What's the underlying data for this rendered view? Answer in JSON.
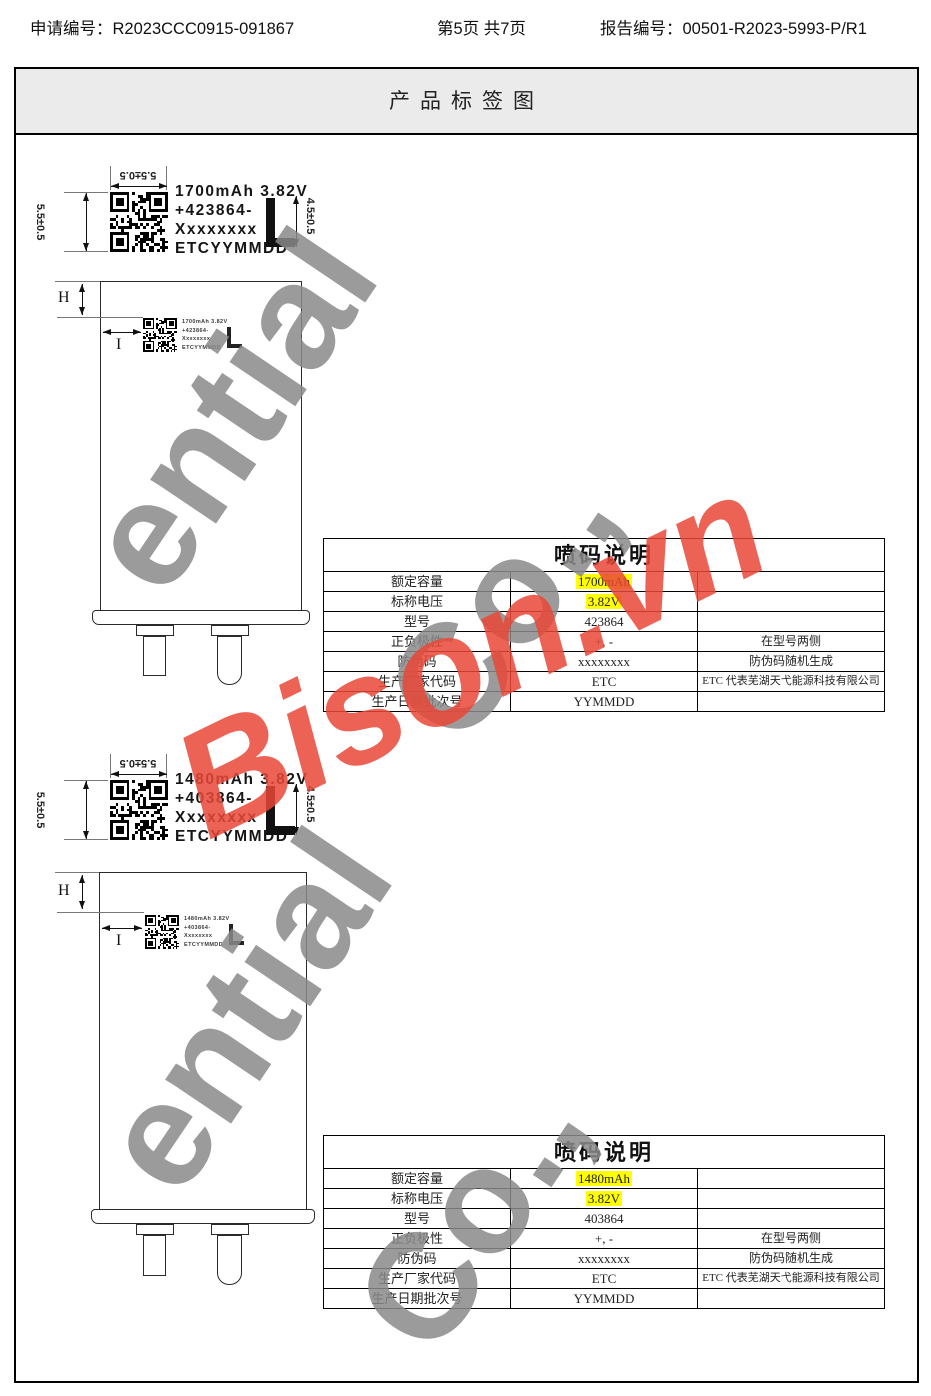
{
  "header": {
    "application_label": "申请编号：R2023CCC0915-091867",
    "page_label": "第5页  共7页",
    "report_label": "报告编号：00501-R2023-5993-P/R1"
  },
  "title": "产品标签图",
  "watermarks": {
    "gray_word": "ential",
    "gray_suffix": "Co.,",
    "red_text": "Bison.vn",
    "gray_color": "#8a8a8a",
    "red_color": "#e94837",
    "highlight_color": "#ffff00"
  },
  "sections": [
    {
      "label": {
        "line1": "1700mAh 3.82V",
        "line2": "+423864-",
        "line3": "Xxxxxxxx",
        "line4": "ETCYYMMDD"
      },
      "dims": {
        "top": "5.5±0.5",
        "left": "5.5±0.5",
        "right": "4.5±0.5",
        "h": "H",
        "i": "I"
      },
      "table": {
        "title": "喷码说明",
        "rows": [
          {
            "name": "额定容量",
            "value": "1700mAh",
            "note": ""
          },
          {
            "name": "标称电压",
            "value": "3.82V",
            "note": ""
          },
          {
            "name": "型号",
            "value": "423864",
            "note": ""
          },
          {
            "name": "正负极性",
            "value": "+, -",
            "note": "在型号两侧"
          },
          {
            "name": "防伪码",
            "value": "xxxxxxxx",
            "note": "防伪码随机生成"
          },
          {
            "name": "生产厂家代码",
            "value": "ETC",
            "note": "ETC 代表芜湖天弋能源科技有限公司"
          },
          {
            "name": "生产日期批次号",
            "value": "YYMMDD",
            "note": ""
          }
        ]
      }
    },
    {
      "label": {
        "line1": "1480mAh 3.82V",
        "line2": "+403864-",
        "line3": "Xxxxxxxx",
        "line4": "ETCYYMMDD"
      },
      "dims": {
        "top": "5.5±0.5",
        "left": "5.5±0.5",
        "right": "4.5±0.5",
        "h": "H",
        "i": "I"
      },
      "table": {
        "title": "喷码说明",
        "rows": [
          {
            "name": "额定容量",
            "value": "1480mAh",
            "note": ""
          },
          {
            "name": "标称电压",
            "value": "3.82V",
            "note": ""
          },
          {
            "name": "型号",
            "value": "403864",
            "note": ""
          },
          {
            "name": "正负极性",
            "value": "+, -",
            "note": "在型号两侧"
          },
          {
            "name": "防伪码",
            "value": "xxxxxxxx",
            "note": "防伪码随机生成"
          },
          {
            "name": "生产厂家代码",
            "value": "ETC",
            "note": "ETC 代表芜湖天弋能源科技有限公司"
          },
          {
            "name": "生产日期批次号",
            "value": "YYMMDD",
            "note": ""
          }
        ]
      }
    }
  ]
}
